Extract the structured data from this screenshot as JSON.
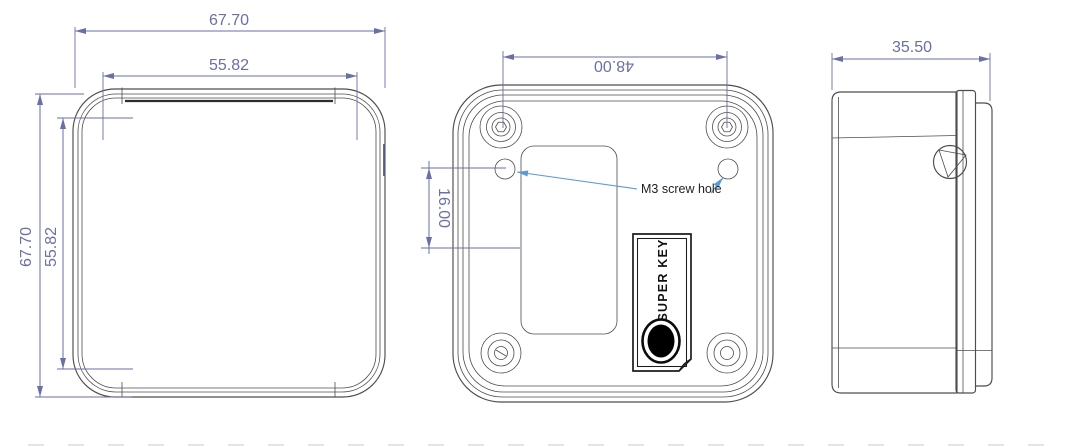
{
  "colors": {
    "background": "#ffffff",
    "outline": "#4d4d4d",
    "dim": "#6a6fa8",
    "leader": "#5b9bd5",
    "anno": "#1f1f1f",
    "keyhole": "#000000"
  },
  "front_view": {
    "width_outer": "67.70",
    "width_inner": "55.82",
    "height_outer": "67.70",
    "height_inner": "55.82"
  },
  "back_view": {
    "hole_spacing": "48.00",
    "hole_offset": "16.00",
    "screw_hole_label": "M3 screw hole",
    "key_label": "SUPER KEY"
  },
  "side_view": {
    "depth": "35.50"
  }
}
